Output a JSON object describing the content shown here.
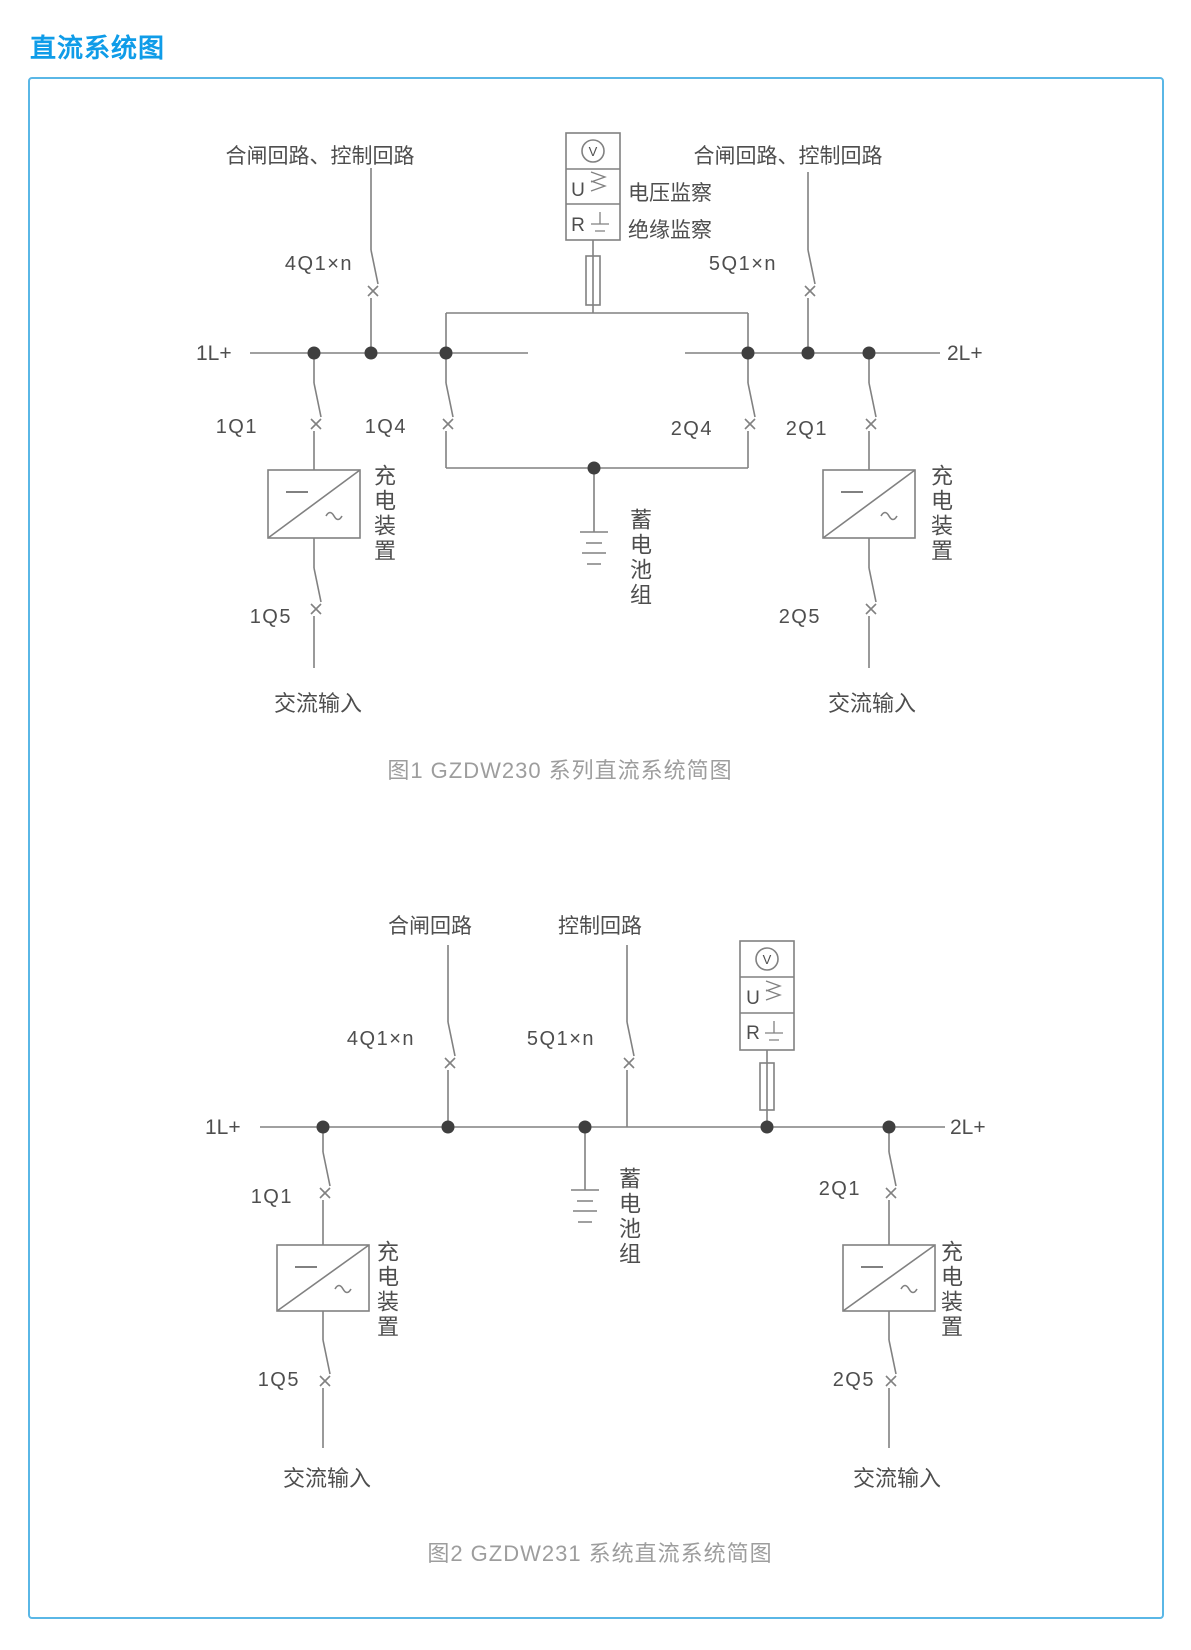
{
  "title": "直流系统图",
  "colors": {
    "title_blue": "#0f9ce8",
    "panel_border": "#5ab7e6",
    "wire_gray": "#818181",
    "text_gray": "#4e4e4e",
    "caption_gray": "#9d9d9d",
    "dot_gray": "#3f3f3f"
  },
  "monitor_legend": {
    "voltmeter": "V",
    "voltage_relay": "U",
    "insulation_relay": "R"
  },
  "diagram1": {
    "caption": "图1 GZDW230 系列直流系统简图",
    "top_label_left": "合闸回路、控制回路",
    "top_label_right": "合闸回路、控制回路",
    "voltage_monitor_label": "电压监察",
    "insulation_monitor_label": "绝缘监察",
    "bus_left": "1L+",
    "bus_right": "2L+",
    "breakers": {
      "b4q1": "4Q1×n",
      "b5q1": "5Q1×n",
      "b1q1": "1Q1",
      "b1q4": "1Q4",
      "b2q4": "2Q4",
      "b2q1": "2Q1",
      "b1q5": "1Q5",
      "b2q5": "2Q5"
    },
    "charger_left": "充电装置",
    "charger_right": "充电装置",
    "battery": "蓄电池组",
    "ac_left": "交流输入",
    "ac_right": "交流输入"
  },
  "diagram2": {
    "caption": "图2 GZDW231 系统直流系统简图",
    "top_label_closing": "合闸回路",
    "top_label_control": "控制回路",
    "bus_left": "1L+",
    "bus_right": "2L+",
    "breakers": {
      "b4q1": "4Q1×n",
      "b5q1": "5Q1×n",
      "b1q1": "1Q1",
      "b2q1": "2Q1",
      "b1q5": "1Q5",
      "b2q5": "2Q5"
    },
    "charger_left": "充电装置",
    "charger_right": "充电装置",
    "battery": "蓄电池组",
    "ac_left": "交流输入",
    "ac_right": "交流输入"
  }
}
